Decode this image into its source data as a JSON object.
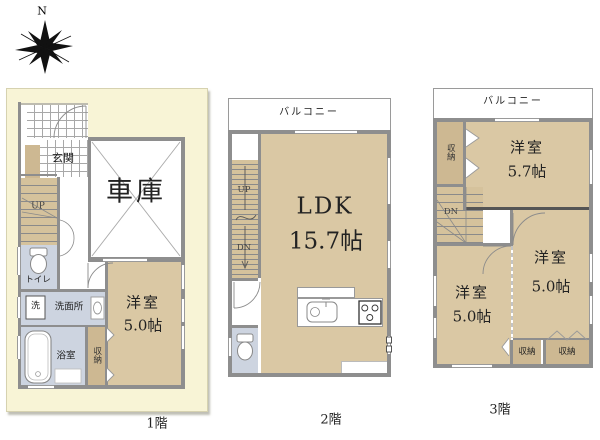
{
  "compass": {
    "north_label": "N"
  },
  "colors": {
    "lot_cream": "#f8f4d6",
    "room_tan": "#dac8a4",
    "closet_tan": "#cdb892",
    "stair_tan": "#d5c29c",
    "wet_blue": "#cdd4e0",
    "wall_gray": "#8e8e8e"
  },
  "f1": {
    "floor_label": "1階",
    "entrance": "玄関",
    "garage": "車庫",
    "stairs_up": "UP",
    "toilet": "トイレ",
    "washer": "洗",
    "washroom": "洗面所",
    "bath": "浴室",
    "closet": "収納",
    "room_name": "洋室",
    "room_size": "5.0帖"
  },
  "f2": {
    "floor_label": "2階",
    "balcony": "バルコニー",
    "stairs_up": "UP",
    "stairs_down": "DN",
    "ldk_name": "LDK",
    "ldk_size": "15.7帖"
  },
  "f3": {
    "floor_label": "3階",
    "balcony": "バルコニー",
    "closet_top": "収納",
    "stairs_down": "DN",
    "room1_name": "洋室",
    "room1_size": "5.7帖",
    "room2_name": "洋室",
    "room2_size": "5.0帖",
    "room3_name": "洋室",
    "room3_size": "5.0帖",
    "closet_b1": "収納",
    "closet_b2": "収納"
  }
}
